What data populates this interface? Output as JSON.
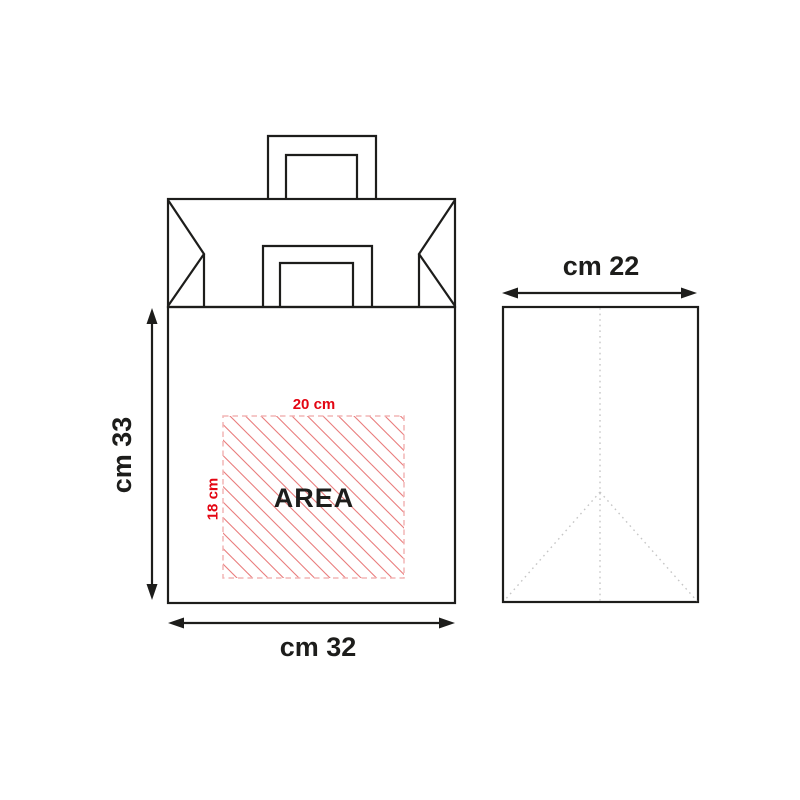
{
  "diagram": {
    "title": "paper-bag-dimensions",
    "front_view": {
      "height_dimension_label": "cm 33",
      "width_dimension_label": "cm 32",
      "print_area": {
        "label": "AREA",
        "width_dimension_label": "20 cm",
        "height_dimension_label": "18 cm"
      }
    },
    "side_view": {
      "depth_dimension_label": "cm 22"
    }
  },
  "colors": {
    "background": "#ffffff",
    "ink": "#1d1d1b",
    "accent-red": "#e30613",
    "hatch-red": "#e97c7c",
    "area-border": "#f2b5b5",
    "fold-dotted": "#c6c6c6"
  }
}
